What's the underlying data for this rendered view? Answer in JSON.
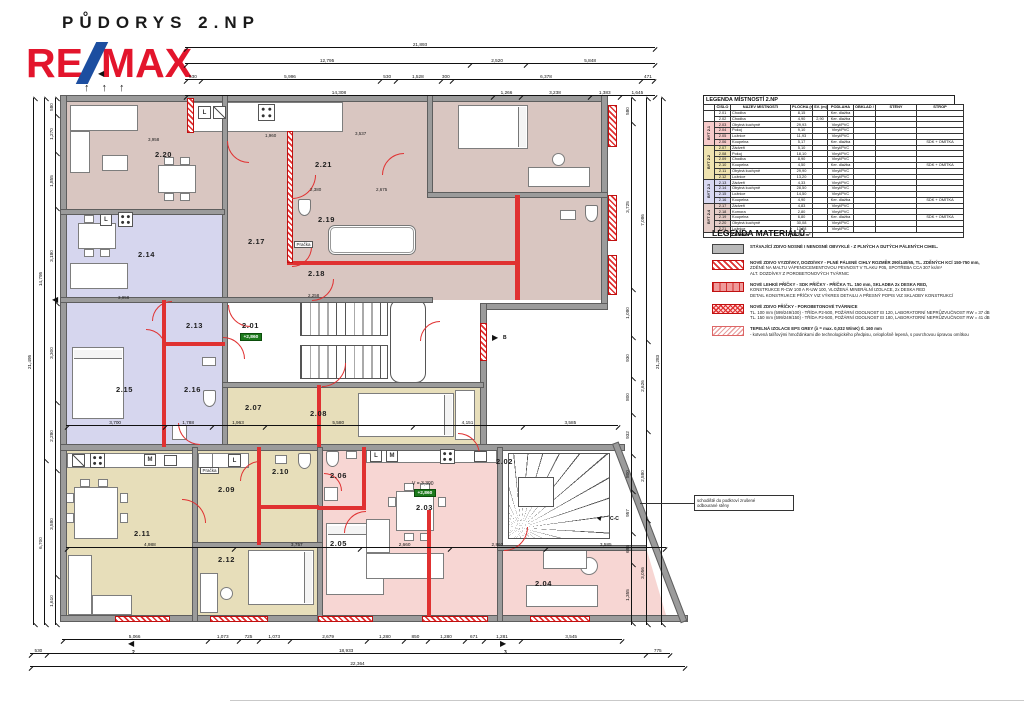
{
  "title": "PŮDORYS 2.NP",
  "logo": {
    "re": "RE",
    "max": "MAX"
  },
  "icons": {
    "arrow_up": "↑",
    "tri_left": "◀",
    "tri_right": "▶",
    "tri_up": "▲"
  },
  "marks": {
    "section_cc": "C-C",
    "section_b": "B",
    "bottom_left": "2",
    "bottom_right": "3"
  },
  "stair_note": {
    "line1": "schodiště do podkroví zrušené",
    "line2": "odbourané stěny"
  },
  "plan": {
    "labels": [
      {
        "x": 95,
        "y": 55,
        "t": "2.20",
        "k": "room"
      },
      {
        "x": 255,
        "y": 65,
        "t": "2.21",
        "k": "room"
      },
      {
        "x": 188,
        "y": 142,
        "t": "2.17",
        "k": "room"
      },
      {
        "x": 258,
        "y": 120,
        "t": "2.19",
        "k": "room"
      },
      {
        "x": 248,
        "y": 174,
        "t": "2.18",
        "k": "room"
      },
      {
        "x": 78,
        "y": 155,
        "t": "2.14",
        "k": "room"
      },
      {
        "x": 126,
        "y": 226,
        "t": "2.13",
        "k": "room"
      },
      {
        "x": 56,
        "y": 290,
        "t": "2.15",
        "k": "room"
      },
      {
        "x": 124,
        "y": 290,
        "t": "2.16",
        "k": "room"
      },
      {
        "x": 182,
        "y": 226,
        "t": "2.01",
        "k": "room"
      },
      {
        "x": 185,
        "y": 308,
        "t": "2.07",
        "k": "room"
      },
      {
        "x": 250,
        "y": 314,
        "t": "2.08",
        "k": "room"
      },
      {
        "x": 158,
        "y": 390,
        "t": "2.09",
        "k": "room"
      },
      {
        "x": 212,
        "y": 372,
        "t": "2.10",
        "k": "room"
      },
      {
        "x": 74,
        "y": 434,
        "t": "2.11",
        "k": "room"
      },
      {
        "x": 158,
        "y": 460,
        "t": "2.12",
        "k": "room"
      },
      {
        "x": 270,
        "y": 376,
        "t": "2.06",
        "k": "room"
      },
      {
        "x": 270,
        "y": 444,
        "t": "2.05",
        "k": "room"
      },
      {
        "x": 356,
        "y": 408,
        "t": "2.03",
        "k": "room"
      },
      {
        "x": 436,
        "y": 362,
        "t": "2.02",
        "k": "room"
      },
      {
        "x": 475,
        "y": 484,
        "t": "2.04",
        "k": "room"
      },
      {
        "x": 180,
        "y": 238,
        "t": "+2,860",
        "k": "badge"
      },
      {
        "x": 354,
        "y": 394,
        "t": "+2,860",
        "k": "badge"
      },
      {
        "x": 352,
        "y": 386,
        "t": "V = 3,390",
        "k": "vol"
      },
      {
        "x": 234,
        "y": 146,
        "t": "Pračka",
        "k": "boxed"
      },
      {
        "x": 140,
        "y": 372,
        "t": "Pračka",
        "k": "boxed"
      },
      {
        "x": 88,
        "y": 42,
        "t": "3,958",
        "k": "dim"
      },
      {
        "x": 205,
        "y": 38,
        "t": "1,960",
        "k": "dim"
      },
      {
        "x": 295,
        "y": 36,
        "t": "3,537",
        "k": "dim"
      },
      {
        "x": 250,
        "y": 92,
        "t": "2,380",
        "k": "dim"
      },
      {
        "x": 316,
        "y": 92,
        "t": "2,675",
        "k": "dim"
      },
      {
        "x": 58,
        "y": 200,
        "t": "3,958",
        "k": "dim"
      },
      {
        "x": 248,
        "y": 198,
        "t": "2,258",
        "k": "dim"
      }
    ],
    "boxes": [
      {
        "x": 138,
        "y": 11,
        "w": 13,
        "h": 13,
        "t": "L"
      },
      {
        "x": 153,
        "y": 11,
        "w": 13,
        "h": 13,
        "k": "slash"
      },
      {
        "x": 198,
        "y": 9,
        "w": 17,
        "h": 17,
        "k": "burners"
      },
      {
        "x": 40,
        "y": 119,
        "w": 12,
        "h": 12,
        "t": "L"
      },
      {
        "x": 58,
        "y": 117,
        "w": 15,
        "h": 15,
        "k": "burners"
      },
      {
        "x": 12,
        "y": 359,
        "w": 13,
        "h": 13,
        "k": "slash"
      },
      {
        "x": 30,
        "y": 358,
        "w": 15,
        "h": 15,
        "k": "burners"
      },
      {
        "x": 84,
        "y": 359,
        "w": 12,
        "h": 12,
        "t": "M"
      },
      {
        "x": 104,
        "y": 360,
        "w": 13,
        "h": 11,
        "k": "sink"
      },
      {
        "x": 168,
        "y": 359,
        "w": 13,
        "h": 13,
        "t": "L"
      },
      {
        "x": 310,
        "y": 355,
        "w": 12,
        "h": 12,
        "t": "L"
      },
      {
        "x": 326,
        "y": 355,
        "w": 12,
        "h": 12,
        "t": "M"
      },
      {
        "x": 380,
        "y": 354,
        "w": 15,
        "h": 15,
        "k": "burners"
      },
      {
        "x": 414,
        "y": 356,
        "w": 13,
        "h": 11,
        "k": "sink"
      }
    ]
  },
  "dimensions": {
    "top": [
      [
        "21,893"
      ],
      [
        "12,795",
        "2,520",
        "5,848"
      ],
      [
        "530",
        "5,996",
        "530",
        "1,528",
        "300",
        "6,378",
        "471"
      ],
      [
        "14,308",
        "1,266",
        "3,238",
        "1,383",
        "1,645"
      ]
    ],
    "bottom": [
      [
        "5,066",
        "1,073",
        "725",
        "1,073",
        "2,679",
        "1,280",
        "850",
        "1,280",
        "671",
        "1,281",
        "3,545"
      ],
      [
        "530",
        "18,933",
        "775"
      ],
      [
        "22,364"
      ]
    ],
    "mid": [
      [
        "3,700",
        "1,788",
        "1,963",
        "5,580",
        "4,151",
        "3,585"
      ],
      [
        "4,988",
        "3,757",
        "2,660",
        "2,860",
        "3,585"
      ]
    ],
    "left": [
      [
        "580",
        "1,270",
        "1,855",
        "3,180",
        "3,300",
        "2,280",
        "3,580",
        "1,610"
      ],
      [
        "14,795",
        "6,700"
      ],
      [
        "21,495"
      ]
    ],
    "right": [
      [
        "580",
        "3,725",
        "1,080",
        "930",
        "800",
        "932",
        "800",
        "957",
        "695",
        "1,355"
      ],
      [
        "7,086",
        "2,626",
        "2,580",
        "3,056"
      ],
      [
        "21,283"
      ]
    ]
  },
  "legend_table": {
    "title": "LEGENDA MÍSTNOSTÍ 2.NP",
    "columns": [
      "ČÍSLO",
      "NÁZEV MÍSTNOSTI",
      "PLOCHA (m²)",
      "SV. (m)",
      "PODLAHA",
      "OBKLAD / DLAŽBA",
      "STĚNY",
      "STROP"
    ],
    "col_widths": [
      13,
      57,
      19,
      12,
      23,
      19,
      38,
      44
    ],
    "rows": [
      {
        "group": "",
        "group_span": 2,
        "group_color": "#ffffff",
        "no": "2.01",
        "name": "Chodba",
        "area": "8,15",
        "sv": "",
        "floor": "Ker. dlažba",
        "tile": "",
        "walls": "",
        "ceiling": "",
        "color": "#ffffff"
      },
      {
        "no": "2.02",
        "name": "Chodba",
        "area": "4,90",
        "sv": "2,90",
        "floor": "Ker. dlažba",
        "tile": "",
        "walls": "",
        "ceiling": "",
        "color": "#ffffff"
      },
      {
        "group": "BYT 2.1",
        "group_span": 4,
        "group_color": "#f6caca",
        "no": "2.03",
        "name": "Obytná kuchyně",
        "area": "29,93",
        "sv": "",
        "floor": "Vinyl/PVC",
        "tile": "",
        "walls": "",
        "ceiling": "",
        "color": "#f6caca"
      },
      {
        "no": "2.04",
        "name": "Pokoj",
        "area": "9,10",
        "sv": "",
        "floor": "Vinyl/PVC",
        "tile": "",
        "walls": "",
        "ceiling": "",
        "color": "#f6caca"
      },
      {
        "no": "2.05",
        "name": "Ložnice",
        "area": "11,93",
        "sv": "",
        "floor": "Vinyl/PVC",
        "tile": "",
        "walls": "",
        "ceiling": "",
        "color": "#f6caca"
      },
      {
        "no": "2.06",
        "name": "Koupelna",
        "area": "5,17",
        "sv": "",
        "floor": "Ker. dlažba",
        "tile": "",
        "walls": "",
        "ceiling": "SDK + OMÍTKA",
        "color": "#f6caca"
      },
      {
        "group": "BYT 2.2",
        "group_span": 6,
        "group_color": "#efe3b0",
        "no": "2.07",
        "name": "Zádveří",
        "area": "5,10",
        "sv": "",
        "floor": "Vinyl/PVC",
        "tile": "",
        "walls": "",
        "ceiling": "",
        "color": "#efe3b0"
      },
      {
        "no": "2.08",
        "name": "Pokoj",
        "area": "18,10",
        "sv": "",
        "floor": "Vinyl/PVC",
        "tile": "",
        "walls": "",
        "ceiling": "",
        "color": "#efe3b0"
      },
      {
        "no": "2.09",
        "name": "Chodba",
        "area": "8,90",
        "sv": "",
        "floor": "Vinyl/PVC",
        "tile": "",
        "walls": "",
        "ceiling": "",
        "color": "#efe3b0"
      },
      {
        "no": "2.10",
        "name": "Koupelna",
        "area": "4,50",
        "sv": "",
        "floor": "Ker. dlažba",
        "tile": "",
        "walls": "",
        "ceiling": "SDK + OMÍTKA",
        "color": "#efe3b0"
      },
      {
        "no": "2.11",
        "name": "Obytná kuchyně",
        "area": "29,90",
        "sv": "",
        "floor": "Vinyl/PVC",
        "tile": "",
        "walls": "",
        "ceiling": "",
        "color": "#efe3b0"
      },
      {
        "no": "2.12",
        "name": "Ložnice",
        "area": "13,20",
        "sv": "",
        "floor": "Vinyl/PVC",
        "tile": "",
        "walls": "",
        "ceiling": "",
        "color": "#efe3b0"
      },
      {
        "group": "BYT 2.3",
        "group_span": 4,
        "group_color": "#d9d9f2",
        "no": "2.13",
        "name": "Zádveří",
        "area": "4,33",
        "sv": "",
        "floor": "Vinyl/PVC",
        "tile": "",
        "walls": "",
        "ceiling": "",
        "color": "#d9d9f2"
      },
      {
        "no": "2.14",
        "name": "Obytná kuchyně",
        "area": "28,50",
        "sv": "",
        "floor": "Vinyl/PVC",
        "tile": "",
        "walls": "",
        "ceiling": "",
        "color": "#d9d9f2"
      },
      {
        "no": "2.15",
        "name": "Ložnice",
        "area": "14,50",
        "sv": "",
        "floor": "Vinyl/PVC",
        "tile": "",
        "walls": "",
        "ceiling": "",
        "color": "#d9d9f2"
      },
      {
        "no": "2.16",
        "name": "Koupelna",
        "area": "4,90",
        "sv": "",
        "floor": "Ker. dlažba",
        "tile": "",
        "walls": "",
        "ceiling": "SDK + OMÍTKA",
        "color": "#d9d9f2"
      },
      {
        "group": "BYT 2.4",
        "group_span": 5,
        "group_color": "#e5cdc8",
        "no": "2.17",
        "name": "Zádveří",
        "area": "4,83",
        "sv": "",
        "floor": "Vinyl/PVC",
        "tile": "",
        "walls": "",
        "ceiling": "",
        "color": "#e5cdc8"
      },
      {
        "no": "2.18",
        "name": "Komora",
        "area": "2,80",
        "sv": "",
        "floor": "Vinyl/PVC",
        "tile": "",
        "walls": "",
        "ceiling": "",
        "color": "#e5cdc8"
      },
      {
        "no": "2.19",
        "name": "Koupelna",
        "area": "6,80",
        "sv": "",
        "floor": "Ker. dlažba",
        "tile": "",
        "walls": "",
        "ceiling": "SDK + OMÍTKA",
        "color": "#e5cdc8"
      },
      {
        "no": "2.20",
        "name": "Obytná kuchyně",
        "area": "30,08",
        "sv": "",
        "floor": "Vinyl/PVC",
        "tile": "",
        "walls": "",
        "ceiling": "",
        "color": "#e5cdc8"
      },
      {
        "no": "2.21",
        "name": "Ložnice",
        "area": "13,28",
        "sv": "",
        "floor": "Vinyl/PVC",
        "tile": "",
        "walls": "",
        "ceiling": "",
        "color": "#e5cdc8"
      }
    ],
    "total_label": "CELKEM",
    "total_value": "257,44 m²"
  },
  "materials_legend": {
    "title": "LEGENDA MATERIÁLŮ",
    "items": [
      {
        "kind": "sw-existing",
        "lines": [
          "STÁVAJÍCÍ ZDIVO NOSNÉ I NENOSNÉ OBVYKLÉ - Z PLNÝCH A DUTÝCH PÁLENÝCH CIHEL."
        ]
      },
      {
        "kind": "sw-masonry",
        "lines": [
          "NOVÉ ZDIVO VYZDÍVKY, DOZDÍVKY - PLNÉ PÁLENÉ CIHLY ROZMĚR 290/140/65, TL. ZDĚNÝCH KCÍ 150-750 mm,",
          "ZDĚNÉ NA MALTU VÁPENOCEMENTOVOU PEVNOST V TLAKU P05, SPOTŘEBA CCA 307 ks/m³",
          "ALT. DOZDÍVKY Z POROBETONOVÝCH TVÁRNIC"
        ]
      },
      {
        "kind": "sw-sdk",
        "lines": [
          "NOVÉ LEHKÉ PŘÍČKY - SDK PŘÍČKY - PŘÍČKA TL. 150 mm, SKLADBA 2x DESKA RED,",
          "KONSTRUKCE R-CW 100 A R-UW 100, VLOŽENÁ MINERÁLNÍ IZOLACE, 2x DESKA RED",
          "DETAIL KONSTRUKCE PŘÍČKY VIZ VÝKRES DETAILU A PŘESNÝ POPIS VIZ SKLADBY KONSTRUKCÍ"
        ]
      },
      {
        "kind": "sw-porobeton",
        "lines": [
          "NOVÉ ZDIVO PŘÍČKY - POROBETONOVÉ TVÁRNICE",
          "TL. 100 mm (599/249/100) - TŘÍDA P2-500, POŽÁRNÍ ODOLNOST EI 120, LABORATORNÍ NEPRŮZVUČNOST RW = 37 dB",
          "TL. 150 mm (599/249/150) - TŘÍDA P2-500, POŽÁRNÍ ODOLNOST EI 180, LABORATORNÍ NEPRŮZVUČNOST RW = 41 dB"
        ]
      },
      {
        "kind": "sw-eps",
        "lines": [
          "TEPELNÁ IZOLACE EPS GREY (λ = max. 0,032 W/mK) tl. 160 mm",
          "- kotvená talířovými hmoždinkami dle technologického předpisu, celoplošně lepená, s povrchovou úpravou omítkou"
        ]
      }
    ]
  }
}
